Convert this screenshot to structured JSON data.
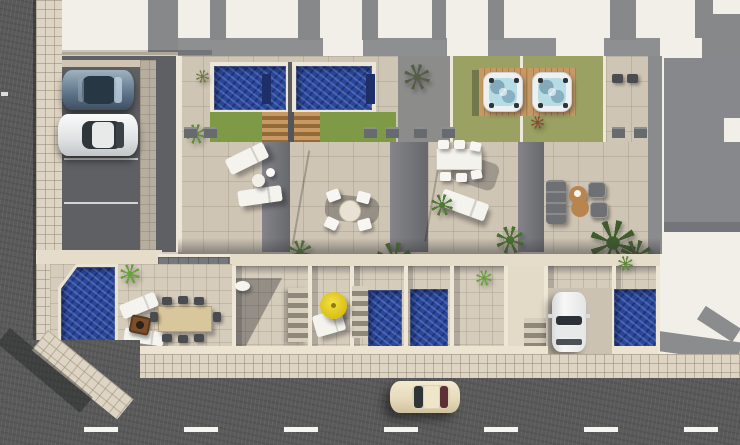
{
  "meta": {
    "type": "architectural-aerial-render",
    "width": 740,
    "height": 445,
    "description": "Top-down 3D render of a row of four modern townhouses with roof terraces, private pools, hot tubs, gardens, a parking court and surrounding streets"
  },
  "palette": {
    "asphalt": "#595a59",
    "sidewalk_tile": "#ded4c3",
    "terrace_tile": "#cfc5b4",
    "yard_tile": "#d6ccbc",
    "roof_white": "#f2efe9",
    "wall_gray": "#87888a",
    "parapet_gray": "#8e8f91",
    "parking_dark": "#5e6063",
    "paver_gray": "#75787c",
    "lawn_green": "#7e9a47",
    "lawn_olive": "#9aa162",
    "pool_blue": "#2b479b",
    "hot_tub_water": "#b7dce6",
    "wood_deck": "#b98b58",
    "umbrella_yellow": "#e8d11f",
    "divider_shadow": "#6b6c70",
    "car_steel_blue": "#6b8097",
    "car_white": "#eceded",
    "car_cream": "#eadfc0",
    "furniture_white": "#f2f1ec",
    "furniture_dark": "#6f7073",
    "lounger_tan": "#b9854e",
    "table_wood": "#d8c69c",
    "fire_pit_brown": "#7c4f2c",
    "plant_green": "#4f7a33",
    "road_line_white": "#f5f5f2"
  },
  "scene": {
    "streets": [
      {
        "name": "side-street-left",
        "orientation": "vertical",
        "markings": "short white dash"
      },
      {
        "name": "main-street-bottom",
        "orientation": "horizontal",
        "markings": "white dashed center line"
      }
    ],
    "vehicles": [
      {
        "name": "steel-blue-car",
        "location": "parking-court-top-left"
      },
      {
        "name": "white-car",
        "location": "parking-court-top-left"
      },
      {
        "name": "white-car",
        "location": "driveway-right-unit"
      },
      {
        "name": "cream-car",
        "location": "main-street-bottom"
      }
    ],
    "units": [
      {
        "name": "corner-unit",
        "upper": [
          "rectangular-pool",
          "lawn",
          "wood-steps"
        ],
        "terrace": [
          "two-sun-loungers",
          "round-side-table"
        ],
        "ground": [
          "corner-pool",
          "two-loungers",
          "fire-pit",
          "long-dining-table-8-chairs"
        ]
      },
      {
        "name": "unit-2",
        "upper": [
          "rectangular-pool",
          "lawn",
          "wood-steps"
        ],
        "terrace": [
          "round-dining-table-4-chairs"
        ],
        "ground": [
          "round-table",
          "staircase",
          "shadowed-patio"
        ]
      },
      {
        "name": "unit-3",
        "upper": [
          "hot-tub-on-wood-deck",
          "olive-lawn",
          "palm-shadow"
        ],
        "terrace": [
          "rect-dining-table-6-chairs",
          "sun-lounger",
          "plants"
        ],
        "ground": [
          "yellow-parasol",
          "lounger",
          "narrow-pool"
        ]
      },
      {
        "name": "unit-4",
        "upper": [
          "hot-tub-on-wood-deck",
          "olive-lawn",
          "two-chairs",
          "flower-plant"
        ],
        "terrace": [
          "sofa",
          "two-armchairs",
          "double-curve-lounger",
          "palm-trees"
        ],
        "ground": [
          "staircase",
          "driveway-with-car",
          "narrow-pool"
        ]
      }
    ],
    "counts": {
      "roof_pools": 2,
      "hot_tubs": 2,
      "ground_pools": 4,
      "staircases": 3,
      "parasols": 1
    },
    "landscaping": [
      "palms",
      "shrubs",
      "bright-green-plants",
      "flowering-plant"
    ],
    "adjacent_plot": {
      "name": "neighboring-building",
      "features": [
        "white-roof",
        "gray-walls",
        "cast-shadow"
      ]
    }
  }
}
